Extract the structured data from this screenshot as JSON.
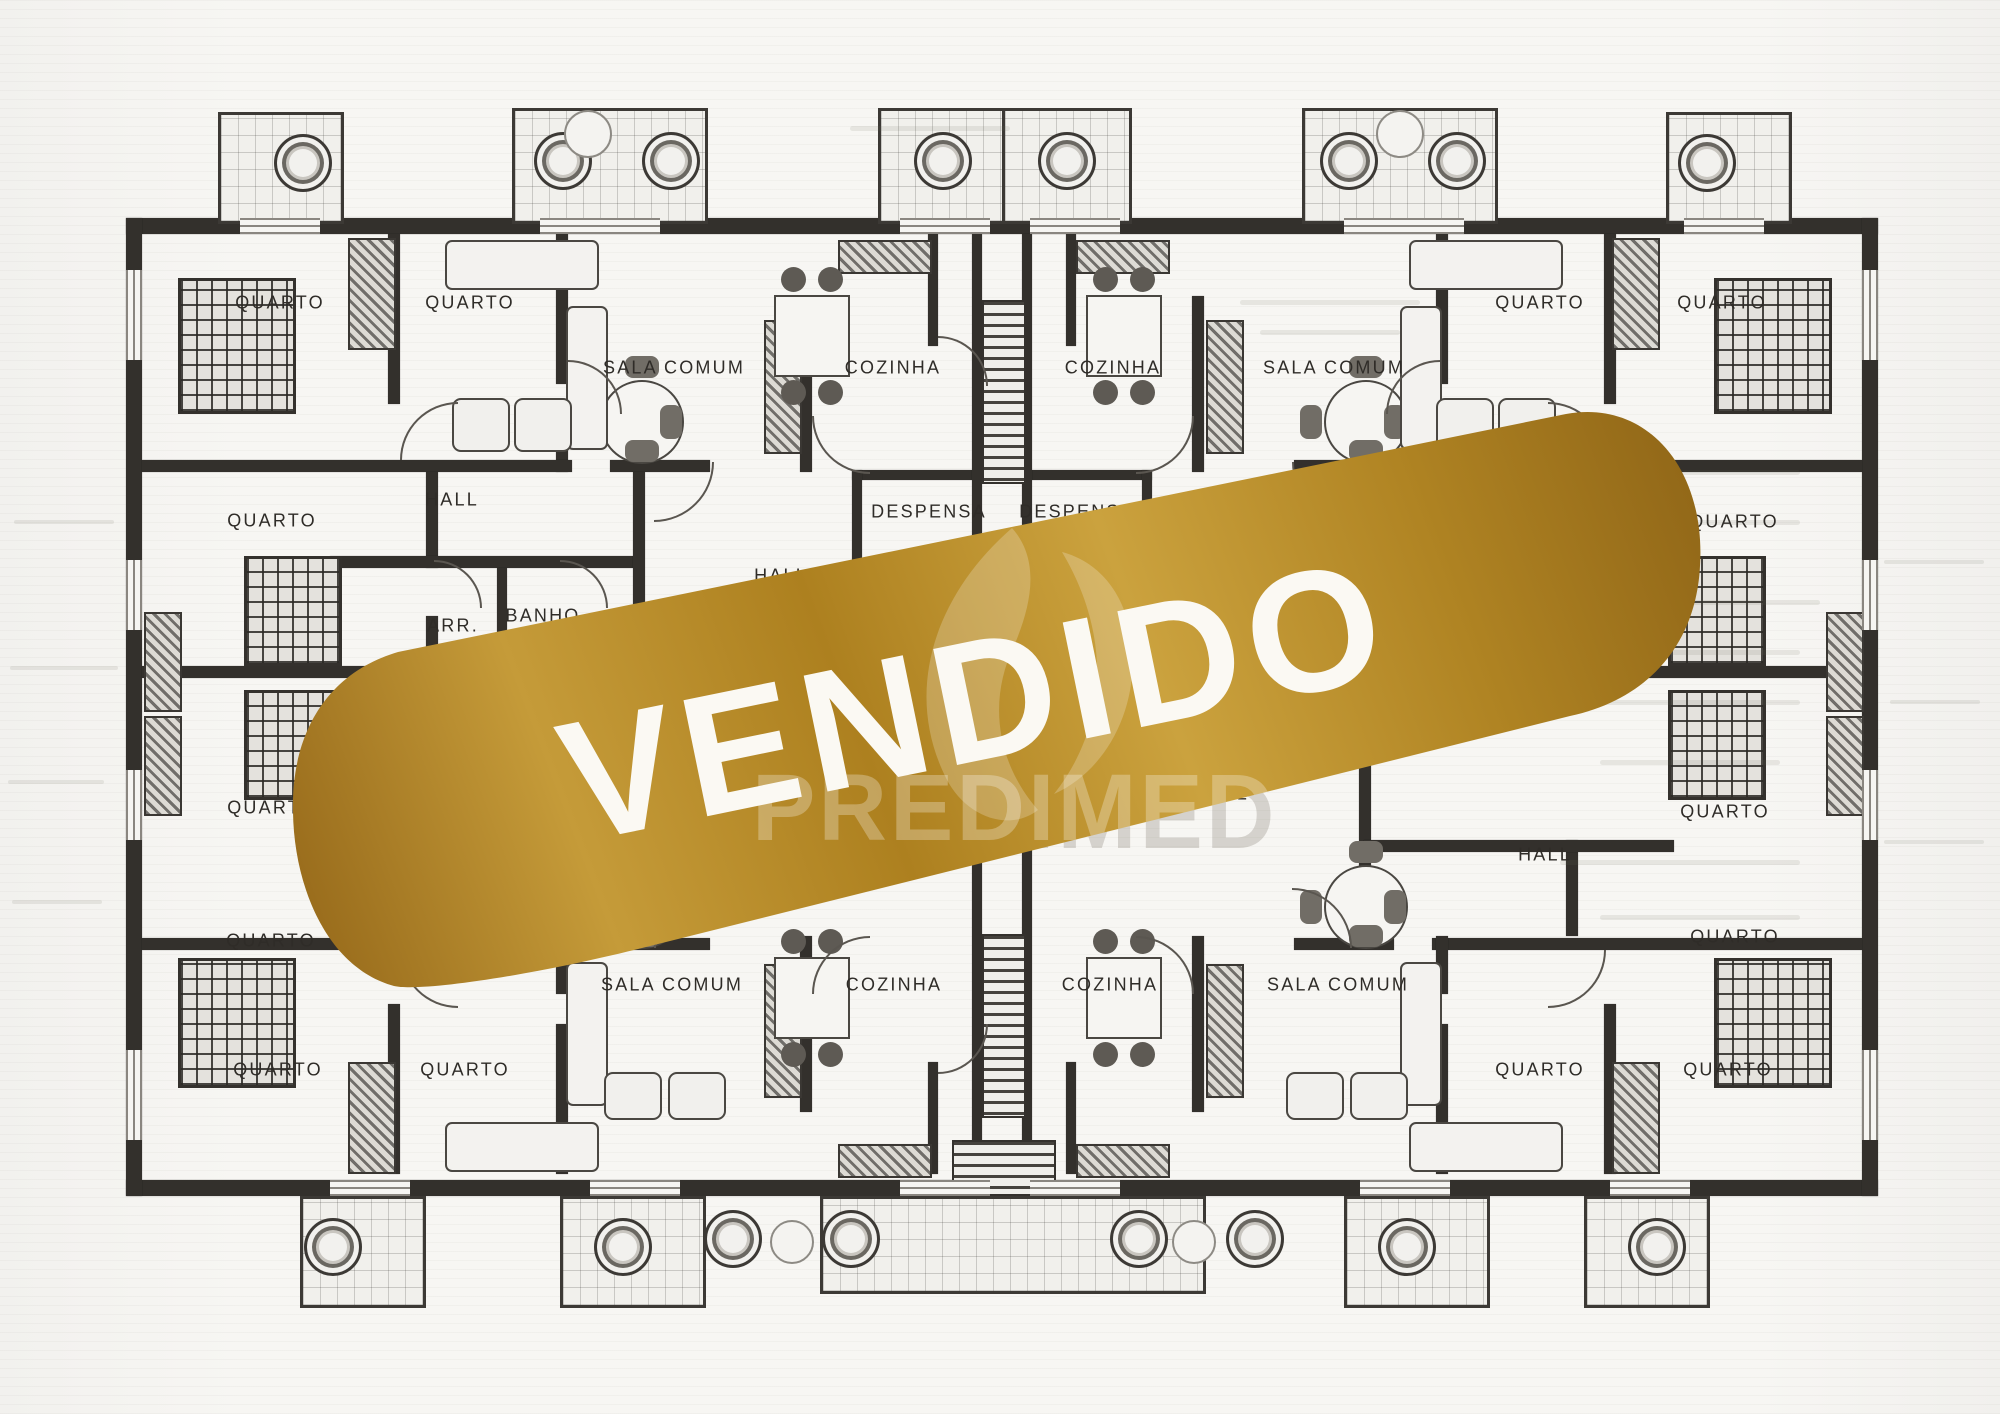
{
  "banner": {
    "text": "VENDIDO",
    "watermark": "PREDIMED",
    "text_color": "#fbf9f3",
    "gold_dark": "#8f6517",
    "gold_mid": "#b5882a",
    "gold_light": "#cda341",
    "angle_deg": -11.6
  },
  "plan": {
    "ink": "#33302c",
    "paper": "#f7f6f3",
    "labels": [
      {
        "text": "QUARTO",
        "x": 280,
        "y": 303
      },
      {
        "text": "QUARTO",
        "x": 470,
        "y": 303
      },
      {
        "text": "SALA  COMUM",
        "x": 674,
        "y": 368
      },
      {
        "text": "COZINHA",
        "x": 893,
        "y": 368
      },
      {
        "text": "COZINHA",
        "x": 1113,
        "y": 368
      },
      {
        "text": "SALA  COMUM",
        "x": 1334,
        "y": 368
      },
      {
        "text": "QUARTO",
        "x": 1540,
        "y": 303
      },
      {
        "text": "QUARTO",
        "x": 1722,
        "y": 303
      },
      {
        "text": "HALL",
        "x": 452,
        "y": 500
      },
      {
        "text": "QUARTO",
        "x": 272,
        "y": 521
      },
      {
        "text": "DESPENSA",
        "x": 929,
        "y": 512
      },
      {
        "text": "DESPENSA",
        "x": 1077,
        "y": 512
      },
      {
        "text": "QUARTO",
        "x": 1734,
        "y": 522
      },
      {
        "text": "HALL",
        "x": 781,
        "y": 576
      },
      {
        "text": "ARR.",
        "x": 453,
        "y": 626
      },
      {
        "text": "BANHO",
        "x": 543,
        "y": 616
      },
      {
        "text": "QUARTO",
        "x": 272,
        "y": 808
      },
      {
        "text": "QUARTO",
        "x": 1725,
        "y": 812
      },
      {
        "text": "HALL",
        "x": 1222,
        "y": 794
      },
      {
        "text": "QUARTO",
        "x": 271,
        "y": 941
      },
      {
        "text": "QUARTO",
        "x": 1735,
        "y": 937
      },
      {
        "text": "HALL",
        "x": 1545,
        "y": 855
      },
      {
        "text": "SALA  COMUM",
        "x": 672,
        "y": 985
      },
      {
        "text": "COZINHA",
        "x": 894,
        "y": 985
      },
      {
        "text": "COZINHA",
        "x": 1110,
        "y": 985
      },
      {
        "text": "SALA  COMUM",
        "x": 1338,
        "y": 985
      },
      {
        "text": "QUARTO",
        "x": 278,
        "y": 1070
      },
      {
        "text": "QUARTO",
        "x": 465,
        "y": 1070
      },
      {
        "text": "QUARTO",
        "x": 1540,
        "y": 1070
      },
      {
        "text": "QUARTO",
        "x": 1728,
        "y": 1070
      }
    ],
    "walls": [
      [
        126,
        218,
        1752,
        16
      ],
      [
        126,
        1180,
        1752,
        16
      ],
      [
        126,
        218,
        16,
        978
      ],
      [
        1862,
        218,
        16,
        978
      ],
      [
        388,
        234,
        12,
        170
      ],
      [
        556,
        234,
        12,
        150
      ],
      [
        556,
        414,
        12,
        58
      ],
      [
        800,
        296,
        12,
        176
      ],
      [
        928,
        234,
        10,
        112
      ],
      [
        142,
        460,
        430,
        12
      ],
      [
        610,
        460,
        100,
        12
      ],
      [
        426,
        472,
        12,
        96
      ],
      [
        426,
        616,
        12,
        56
      ],
      [
        330,
        556,
        310,
        12
      ],
      [
        497,
        568,
        10,
        104
      ],
      [
        633,
        472,
        12,
        200
      ],
      [
        142,
        666,
        294,
        12
      ],
      [
        852,
        470,
        148,
        10
      ],
      [
        852,
        470,
        10,
        124
      ],
      [
        852,
        588,
        64,
        10
      ],
      [
        960,
        588,
        40,
        10
      ],
      [
        1604,
        234,
        12,
        170
      ],
      [
        1436,
        234,
        12,
        150
      ],
      [
        1436,
        414,
        12,
        58
      ],
      [
        1192,
        296,
        12,
        176
      ],
      [
        1066,
        234,
        10,
        112
      ],
      [
        1432,
        460,
        430,
        12
      ],
      [
        1294,
        460,
        100,
        12
      ],
      [
        1566,
        472,
        12,
        96
      ],
      [
        1566,
        616,
        12,
        56
      ],
      [
        1364,
        556,
        310,
        12
      ],
      [
        1497,
        568,
        10,
        104
      ],
      [
        1359,
        472,
        12,
        200
      ],
      [
        1568,
        666,
        294,
        12
      ],
      [
        1004,
        470,
        148,
        10
      ],
      [
        1142,
        470,
        10,
        124
      ],
      [
        1088,
        588,
        64,
        10
      ],
      [
        1004,
        588,
        40,
        10
      ],
      [
        972,
        234,
        10,
        360
      ],
      [
        1022,
        234,
        10,
        360
      ],
      [
        972,
        820,
        10,
        360
      ],
      [
        1022,
        820,
        10,
        360
      ],
      [
        142,
        938,
        430,
        12
      ],
      [
        610,
        938,
        100,
        12
      ],
      [
        1432,
        938,
        430,
        12
      ],
      [
        1294,
        938,
        100,
        12
      ],
      [
        388,
        1004,
        12,
        170
      ],
      [
        556,
        1024,
        12,
        150
      ],
      [
        556,
        936,
        12,
        58
      ],
      [
        800,
        936,
        12,
        176
      ],
      [
        928,
        1062,
        10,
        112
      ],
      [
        1604,
        1004,
        12,
        170
      ],
      [
        1436,
        1024,
        12,
        150
      ],
      [
        1436,
        936,
        12,
        58
      ],
      [
        1192,
        936,
        12,
        176
      ],
      [
        1066,
        1062,
        10,
        112
      ],
      [
        426,
        840,
        12,
        96
      ],
      [
        633,
        736,
        12,
        200
      ],
      [
        1566,
        840,
        12,
        96
      ],
      [
        1359,
        736,
        12,
        200
      ],
      [
        330,
        840,
        310,
        12
      ],
      [
        1364,
        840,
        310,
        12
      ]
    ],
    "balconies": [
      [
        218,
        112,
        120,
        106
      ],
      [
        512,
        108,
        190,
        110
      ],
      [
        878,
        108,
        124,
        110
      ],
      [
        1002,
        108,
        124,
        110
      ],
      [
        1302,
        108,
        190,
        110
      ],
      [
        1666,
        112,
        120,
        106
      ],
      [
        300,
        1196,
        120,
        106
      ],
      [
        560,
        1196,
        140,
        106
      ],
      [
        820,
        1196,
        380,
        92
      ],
      [
        1344,
        1196,
        140,
        106
      ],
      [
        1584,
        1196,
        120,
        106
      ]
    ],
    "stairs": [
      [
        982,
        300,
        40,
        180
      ],
      [
        982,
        934,
        40,
        180
      ],
      [
        952,
        1140,
        100,
        52
      ]
    ],
    "beds": [
      [
        178,
        278,
        112,
        130
      ],
      [
        1714,
        278,
        112,
        130
      ],
      [
        178,
        958,
        112,
        124
      ],
      [
        1714,
        958,
        112,
        124
      ],
      [
        244,
        556,
        92,
        104
      ],
      [
        244,
        690,
        92,
        104
      ],
      [
        1668,
        556,
        92,
        104
      ],
      [
        1668,
        690,
        92,
        104
      ]
    ],
    "closets": [
      [
        348,
        238,
        44,
        108
      ],
      [
        1612,
        238,
        44,
        108
      ],
      [
        348,
        1062,
        44,
        108
      ],
      [
        1612,
        1062,
        44,
        108
      ],
      [
        144,
        612,
        34,
        96
      ],
      [
        144,
        716,
        34,
        96
      ],
      [
        1826,
        612,
        34,
        96
      ],
      [
        1826,
        716,
        34,
        96
      ],
      [
        838,
        240,
        90,
        30
      ],
      [
        1076,
        240,
        90,
        30
      ],
      [
        838,
        1144,
        90,
        30
      ],
      [
        1076,
        1144,
        90,
        30
      ],
      [
        764,
        320,
        34,
        130
      ],
      [
        1206,
        320,
        34,
        130
      ],
      [
        764,
        964,
        34,
        130
      ],
      [
        1206,
        964,
        34,
        130
      ]
    ],
    "tables_round": [
      [
        640,
        420,
        80
      ],
      [
        1364,
        420,
        80
      ],
      [
        640,
        905,
        80
      ],
      [
        1364,
        905,
        80
      ]
    ],
    "tables_small": [
      [
        810,
        334,
        72,
        78
      ],
      [
        1122,
        334,
        72,
        78
      ],
      [
        810,
        996,
        72,
        78
      ],
      [
        1122,
        996,
        72,
        78
      ]
    ],
    "sofas": [
      [
        445,
        240,
        150,
        46
      ],
      [
        566,
        306,
        38,
        140
      ],
      [
        1409,
        240,
        150,
        46
      ],
      [
        1400,
        306,
        38,
        140
      ],
      [
        445,
        1122,
        150,
        46
      ],
      [
        566,
        962,
        38,
        140
      ],
      [
        1409,
        1122,
        150,
        46
      ],
      [
        1400,
        962,
        38,
        140
      ]
    ],
    "armchairs": [
      [
        452,
        398,
        54,
        50
      ],
      [
        514,
        398,
        54,
        50
      ],
      [
        1436,
        398,
        54,
        50
      ],
      [
        1498,
        398,
        54,
        50
      ],
      [
        604,
        1072,
        54,
        44
      ],
      [
        668,
        1072,
        54,
        44
      ],
      [
        1286,
        1072,
        54,
        44
      ],
      [
        1350,
        1072,
        54,
        44
      ]
    ],
    "doors": [
      [
        400,
        402,
        56,
        0
      ],
      [
        568,
        360,
        52,
        90
      ],
      [
        812,
        416,
        56,
        270
      ],
      [
        880,
        596,
        48,
        180
      ],
      [
        1076,
        596,
        48,
        90
      ],
      [
        434,
        560,
        46,
        90
      ],
      [
        560,
        560,
        46,
        90
      ],
      [
        938,
        336,
        48,
        90
      ],
      [
        654,
        462,
        58,
        180
      ],
      [
        1292,
        462,
        58,
        270
      ],
      [
        1548,
        402,
        56,
        90
      ],
      [
        1386,
        360,
        52,
        0
      ],
      [
        1136,
        416,
        56,
        180
      ],
      [
        938,
        1024,
        48,
        180
      ],
      [
        400,
        950,
        56,
        270
      ],
      [
        1548,
        950,
        56,
        180
      ],
      [
        654,
        888,
        58,
        0
      ],
      [
        1292,
        888,
        58,
        90
      ],
      [
        812,
        936,
        56,
        0
      ],
      [
        1136,
        936,
        56,
        90
      ]
    ],
    "planters": [
      [
        300,
        160,
        52
      ],
      [
        560,
        158,
        52
      ],
      [
        668,
        158,
        52
      ],
      [
        940,
        158,
        52
      ],
      [
        1064,
        158,
        52
      ],
      [
        1346,
        158,
        52
      ],
      [
        1454,
        158,
        52
      ],
      [
        1704,
        160,
        52
      ],
      [
        330,
        1244,
        52
      ],
      [
        620,
        1244,
        52
      ],
      [
        730,
        1236,
        52
      ],
      [
        848,
        1236,
        52
      ],
      [
        1136,
        1236,
        52
      ],
      [
        1252,
        1236,
        52
      ],
      [
        1404,
        1244,
        52
      ],
      [
        1654,
        1244,
        52
      ]
    ],
    "rings": [
      [
        586,
        132,
        44
      ],
      [
        1398,
        132,
        44
      ],
      [
        790,
        1240,
        40
      ],
      [
        1192,
        1240,
        40
      ]
    ],
    "windows_h": [
      [
        240,
        218,
        80
      ],
      [
        540,
        218,
        120
      ],
      [
        900,
        218,
        90
      ],
      [
        1030,
        218,
        90
      ],
      [
        1344,
        218,
        120
      ],
      [
        1684,
        218,
        80
      ],
      [
        330,
        1180,
        80
      ],
      [
        590,
        1180,
        90
      ],
      [
        900,
        1180,
        90
      ],
      [
        1030,
        1180,
        90
      ],
      [
        1360,
        1180,
        90
      ],
      [
        1610,
        1180,
        80
      ]
    ],
    "windows_v": [
      [
        126,
        270,
        90
      ],
      [
        126,
        560,
        70
      ],
      [
        126,
        770,
        70
      ],
      [
        126,
        1050,
        90
      ],
      [
        1862,
        270,
        90
      ],
      [
        1862,
        560,
        70
      ],
      [
        1862,
        770,
        70
      ],
      [
        1862,
        1050,
        90
      ]
    ],
    "ghosts": [
      [
        14,
        520,
        100,
        4
      ],
      [
        10,
        666,
        108,
        4
      ],
      [
        8,
        780,
        96,
        4
      ],
      [
        12,
        900,
        90,
        4
      ],
      [
        1560,
        470,
        240,
        5
      ],
      [
        1600,
        520,
        200,
        5
      ],
      [
        1560,
        600,
        260,
        5
      ],
      [
        1590,
        650,
        210,
        5
      ],
      [
        1560,
        700,
        240,
        5
      ],
      [
        1600,
        760,
        180,
        5
      ],
      [
        1560,
        860,
        240,
        5
      ],
      [
        1600,
        915,
        200,
        5
      ],
      [
        1240,
        300,
        180,
        5
      ],
      [
        1260,
        330,
        140,
        5
      ],
      [
        850,
        126,
        160,
        5
      ],
      [
        1884,
        560,
        100,
        4
      ],
      [
        1890,
        700,
        90,
        4
      ],
      [
        1884,
        840,
        100,
        4
      ]
    ]
  }
}
